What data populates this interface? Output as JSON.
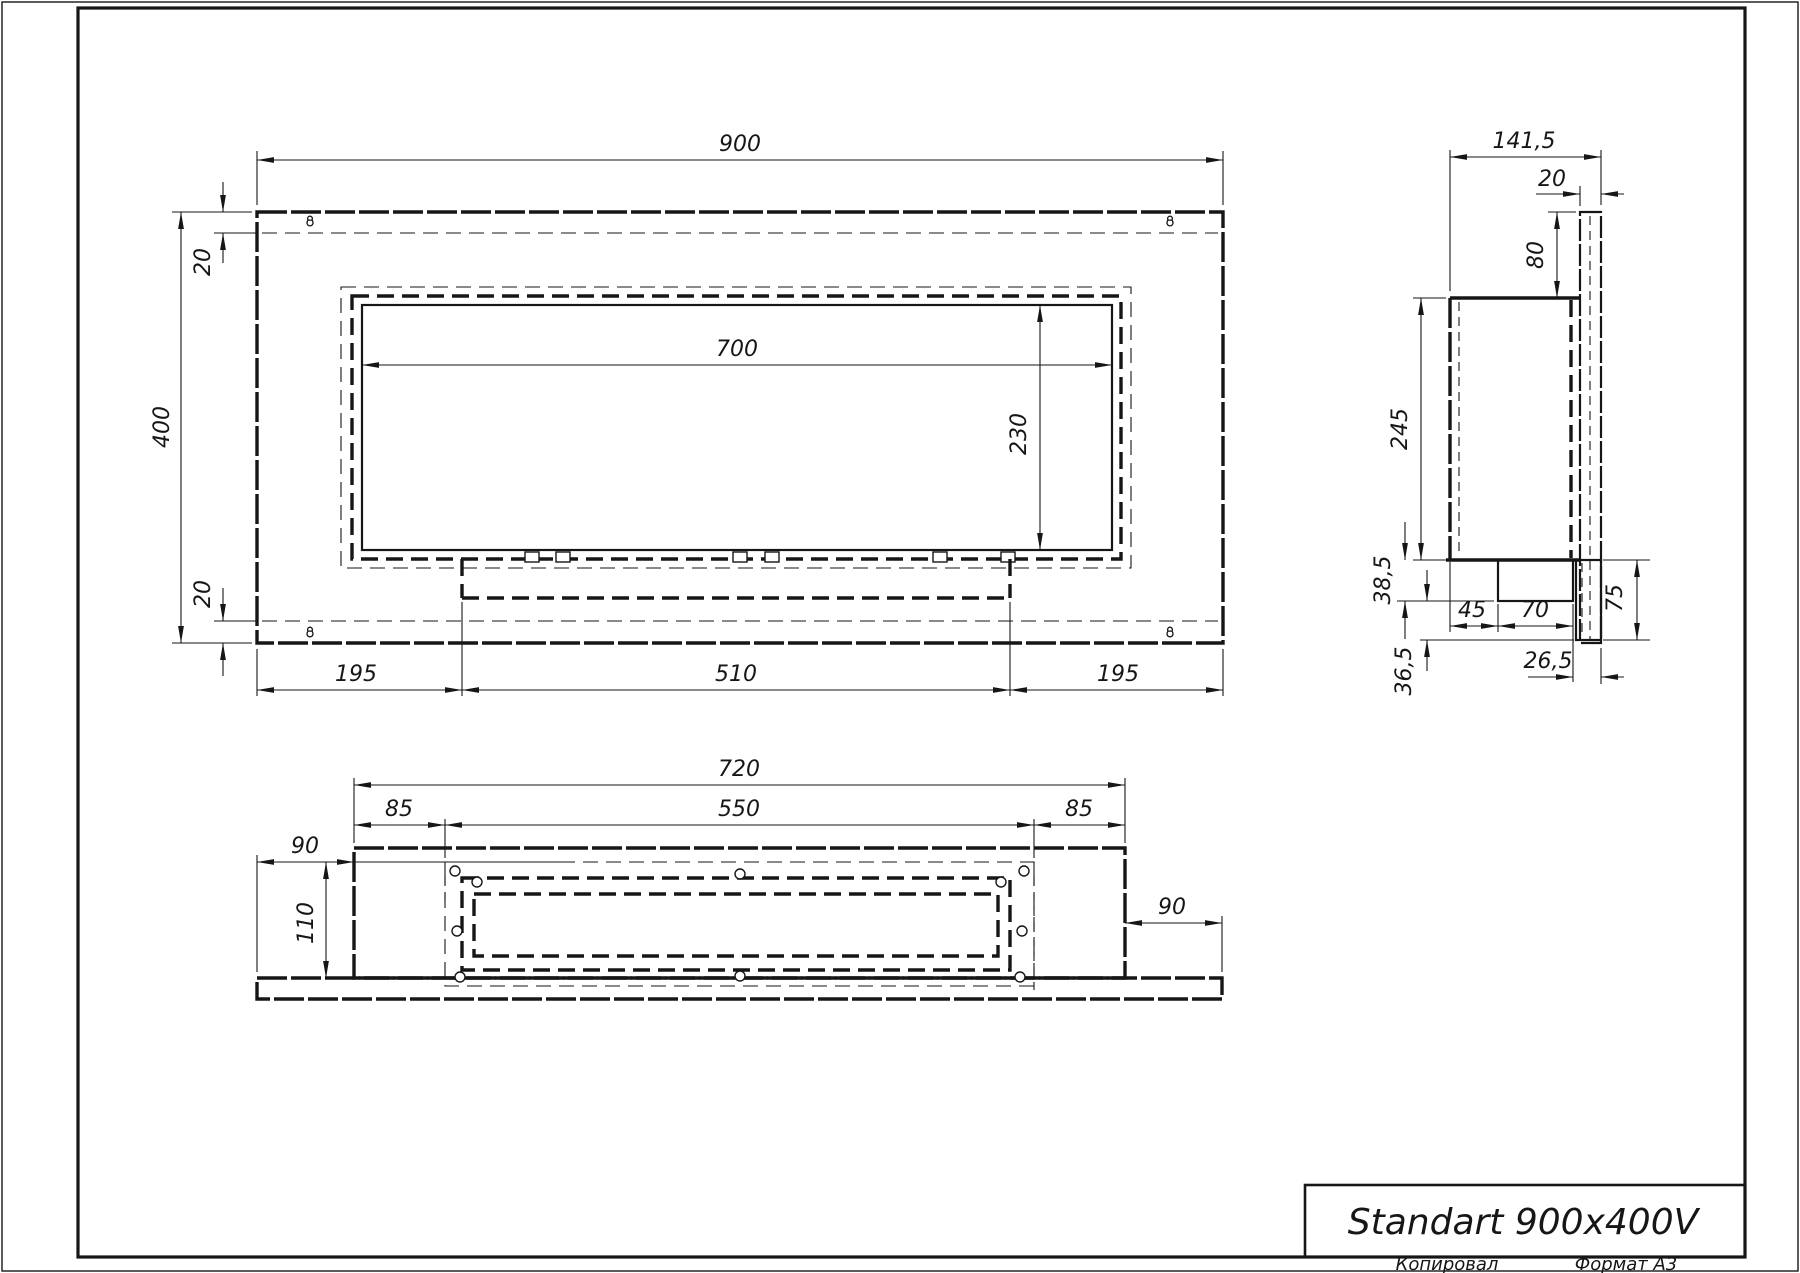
{
  "sheet": {
    "copied_label": "Копировал",
    "format_label": "Формат А3"
  },
  "title_block": {
    "title": "Standart 900x400V"
  },
  "icons": {
    "mounting_slot": "keyhole"
  },
  "views": {
    "front": {
      "dims": {
        "total_width": "900",
        "total_height": "400",
        "top_offset": "20",
        "bottom_offset": "20",
        "opening_width": "700",
        "opening_height": "230",
        "left_margin": "195",
        "burner_width": "510",
        "right_margin": "195"
      }
    },
    "side": {
      "dims": {
        "depth": "141,5",
        "plate_thickness": "20",
        "top_gap": "80",
        "body_height": "245",
        "tray_depth": "38,5",
        "front_to_tray": "45",
        "tray_width": "70",
        "bracket_height": "75",
        "tray_to_plate": "26,5",
        "below_body": "36,5"
      }
    },
    "bottom": {
      "dims": {
        "body_width": "720",
        "screw_span": "550",
        "left_inset": "85",
        "right_inset": "85",
        "left_flange": "90",
        "right_flange": "90",
        "body_depth": "110"
      }
    }
  }
}
